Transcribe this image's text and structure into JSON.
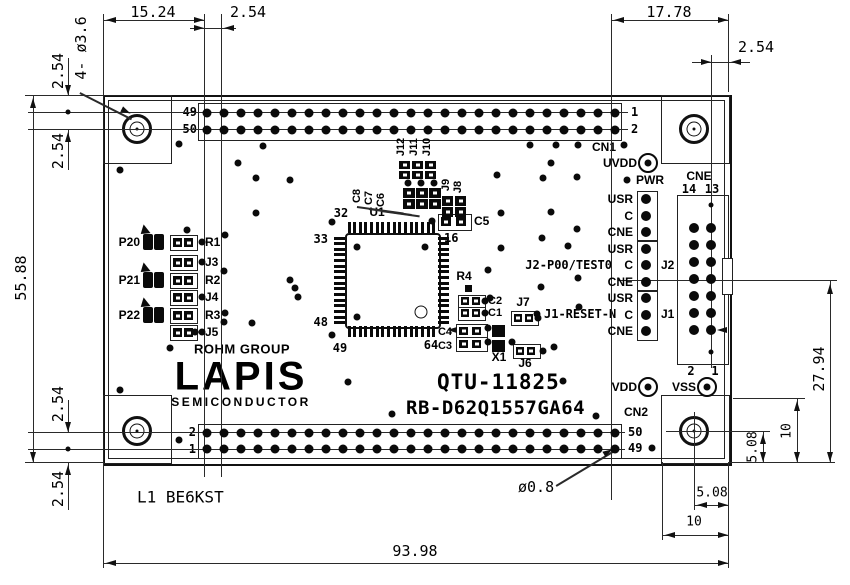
{
  "dimensions": {
    "d_top_left": "15.24",
    "d_top_left2": "2.54",
    "d_top_right": "17.78",
    "d_top_right2": "2.54",
    "d_left_a": "2.54",
    "d_left_b": "2.54",
    "d_height": "55.88",
    "d_left_c": "2.54",
    "d_left_d": "2.54",
    "d_width": "93.98",
    "d_right_center": "27.94",
    "d_right_sq": "10",
    "d_right_hole": "5.08",
    "d_bot_hole": "5.08",
    "d_bot_sq": "10",
    "hole_callout": "4- ø3.6",
    "pin_dia": "ø0.8"
  },
  "board": {
    "note": "L1 BE6KST",
    "logo_group": "ROHM GROUP",
    "logo": "LAPIS",
    "logo_sub": "SEMICONDUCTOR",
    "part_no": "QTU-11825",
    "model": "RB-D62Q1557GA64"
  },
  "cn1": {
    "name": "CN1",
    "left_top": "49",
    "left_bot": "50",
    "right_top": "1",
    "right_bot": "2",
    "pins_per_row": 25
  },
  "cn2": {
    "name": "CN2",
    "left_top": "2",
    "left_bot": "1",
    "right_top": "50",
    "right_bot": "49",
    "pins_per_row": 25
  },
  "cne": {
    "name": "CNE",
    "top_left": "14",
    "top_right": "13",
    "bot_left": "2",
    "bot_right": "1",
    "rows": 7
  },
  "power": {
    "uvdd": "UVDD",
    "pwr": "PWR",
    "vdd": "VDD",
    "vss": "VSS",
    "vss2": "2",
    "vss1": "1"
  },
  "jumpers": {
    "rows": [
      "USR",
      "C",
      "CNE",
      "USR",
      "C",
      "CNE",
      "USR",
      "C",
      "CNE"
    ],
    "j2": "J2",
    "j1": "J1",
    "note_j2": "J2-P00/TEST0",
    "note_j1": "J1-RESET-N"
  },
  "u1": {
    "ref": "U1",
    "p32": "32",
    "p33": "33",
    "p48": "48",
    "p49": "49",
    "p64": "64",
    "p16": "16"
  },
  "parts": {
    "j12": "J12",
    "j11": "J11",
    "j10": "J10",
    "c8": "C8",
    "c7": "C7",
    "c6": "C6",
    "j9": "J9",
    "j8": "J8",
    "c5": "C5",
    "r4": "R4",
    "c2": "C2",
    "c1": "C1",
    "c4": "C4",
    "c3": "C3",
    "x1": "X1",
    "j7": "J7",
    "j6": "J6"
  },
  "led_rows": [
    {
      "port": "P20",
      "ref": "R1"
    },
    {
      "port": "",
      "ref": "J3"
    },
    {
      "port": "P21",
      "ref": "R2"
    },
    {
      "port": "",
      "ref": "J4"
    },
    {
      "port": "P22",
      "ref": "R3"
    },
    {
      "port": "",
      "ref": "J5"
    }
  ]
}
